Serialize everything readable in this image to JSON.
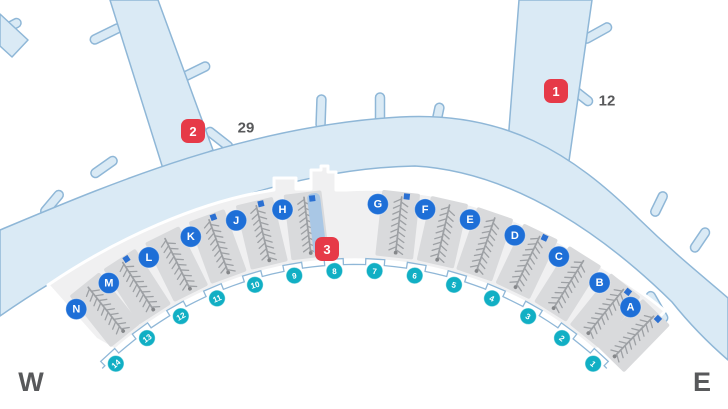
{
  "compass": {
    "west": "W",
    "east": "E"
  },
  "colors": {
    "apron_fill": "#daeaf5",
    "apron_stroke": "#8fb7d7",
    "terminal_fill": "#f0f0f1",
    "terminal_stroke": "#ffffff",
    "gatebox_fill": "#d9dadc",
    "seat_stroke": "#9da0a4",
    "marker_blue": "#2b70d2",
    "walkway_fill": "#a9c7e5",
    "gate_badge": "#1e6fd7",
    "door_badge": "#11afc4",
    "alert_red": "#e63a48",
    "curb_stroke": "#8fb7d7",
    "note_text": "#58595b",
    "compass_text": "#58595b"
  },
  "gates": [
    {
      "label": "N",
      "angle": -41.6,
      "marker": false,
      "walkway": false
    },
    {
      "label": "M",
      "angle": -35.9,
      "marker": true,
      "walkway": false
    },
    {
      "label": "L",
      "angle": -29.4,
      "marker": false,
      "walkway": false
    },
    {
      "label": "K",
      "angle": -23.0,
      "marker": true,
      "walkway": false
    },
    {
      "label": "J",
      "angle": -16.4,
      "marker": true,
      "walkway": false
    },
    {
      "label": "H",
      "angle": -9.9,
      "marker": true,
      "walkway": true
    },
    {
      "label": "G",
      "angle": 3.2,
      "marker": true,
      "walkway": false
    },
    {
      "label": "F",
      "angle": 9.7,
      "marker": false,
      "walkway": false
    },
    {
      "label": "E",
      "angle": 16.0,
      "marker": false,
      "walkway": false
    },
    {
      "label": "D",
      "angle": 22.5,
      "marker": true,
      "walkway": false
    },
    {
      "label": "C",
      "angle": 29.2,
      "marker": false,
      "walkway": false
    },
    {
      "label": "B",
      "angle": 35.8,
      "marker": true,
      "walkway": false
    },
    {
      "label": "A",
      "angle": 41.2,
      "marker": true,
      "walkway": false
    }
  ],
  "doors": [
    {
      "label": "1",
      "angle": 42.7
    },
    {
      "label": "2",
      "angle": 36.13
    },
    {
      "label": "3",
      "angle": 29.56
    },
    {
      "label": "4",
      "angle": 22.99
    },
    {
      "label": "5",
      "angle": 16.42
    },
    {
      "label": "6",
      "angle": 9.85
    },
    {
      "label": "7",
      "angle": 3.28
    },
    {
      "label": "8",
      "angle": -3.28
    },
    {
      "label": "9",
      "angle": -9.85
    },
    {
      "label": "10",
      "angle": -16.42
    },
    {
      "label": "11",
      "angle": -22.99
    },
    {
      "label": "12",
      "angle": -29.56
    },
    {
      "label": "13",
      "angle": -36.13
    },
    {
      "label": "14",
      "angle": -42.7
    }
  ],
  "alerts": [
    {
      "label": "1",
      "x": 556,
      "y": 91,
      "note": "12",
      "note_x": 607,
      "note_y": 101
    },
    {
      "label": "2",
      "x": 193,
      "y": 131,
      "note": "29",
      "note_x": 246,
      "note_y": 128
    },
    {
      "label": "3",
      "x": 327,
      "y": 249,
      "note": "",
      "note_x": 0,
      "note_y": 0
    }
  ]
}
